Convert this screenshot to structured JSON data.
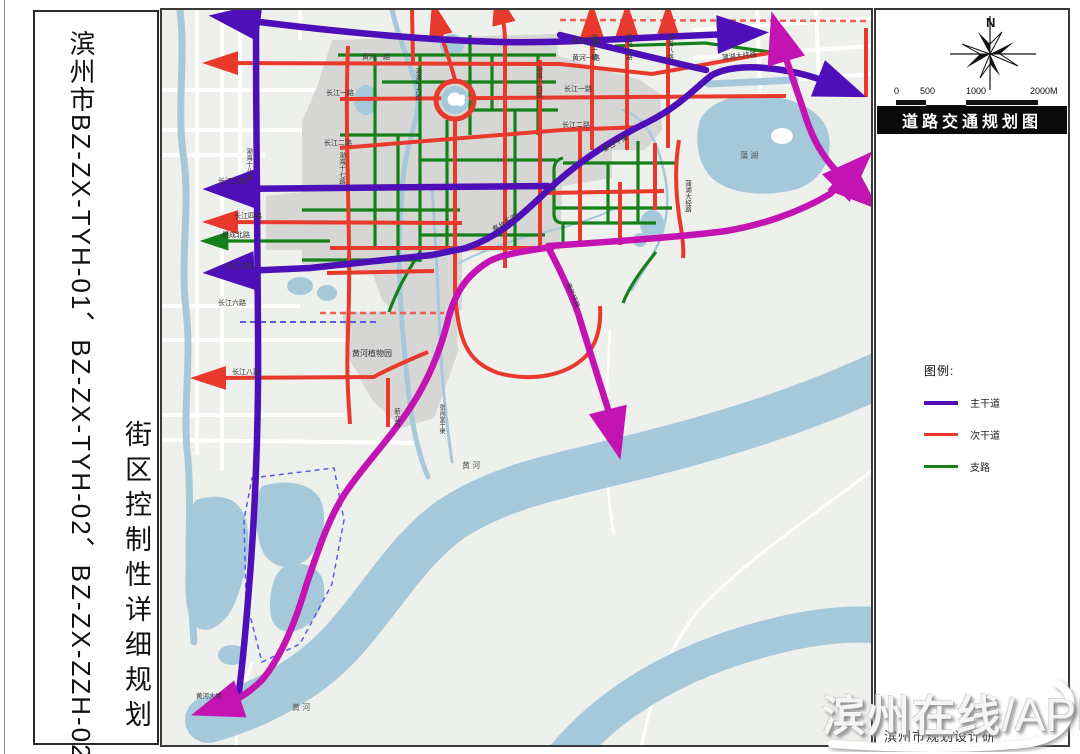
{
  "sheet": {
    "project_title_line1": "滨州市BZ-ZX-TYH-01、BZ-ZX-TYH-02、BZ-ZX-ZZH-02",
    "project_title_line2": "街区控制性详细规划"
  },
  "panel": {
    "compass_label": "N",
    "scale_ticks": [
      "0",
      "500",
      "1000",
      "2000M"
    ],
    "map_title": "道路交通规划图",
    "legend_title": "图例:",
    "legend": [
      {
        "label": "主干道",
        "color": "#4e0fb8"
      },
      {
        "label": "次干道",
        "color": "#e8392c"
      },
      {
        "label": "支路",
        "color": "#15801a"
      }
    ],
    "credit": "滨州市规划设计研"
  },
  "watermark": {
    "text": "滨州在线",
    "slash": "/",
    "suffix": "APP"
  },
  "map": {
    "colors": {
      "main_road": "#4e0fb8",
      "secondary_road": "#e8392c",
      "branch_road": "#15801a",
      "expressway": "#c313b3",
      "water": "#a5c8db",
      "urban": "#d6d7d5",
      "land": "#eef0ec"
    },
    "labels": {
      "hh2": "黄河二路",
      "hh1w": "黄河一路",
      "hh1e": "黄河一路",
      "cj1w": "长江一路",
      "cj1e": "长江一路",
      "cj2w": "长江二路",
      "cj2e": "长江二路",
      "cj3": "长江三路",
      "cj4": "长江四路",
      "kcb": "垦成北路",
      "cj5": "长江五路",
      "cj6": "长江六路",
      "cj8": "长江八路",
      "bh18": "渤海十八路",
      "bh17": "渤海十七路",
      "bh16": "渤海十六路",
      "bh14": "渤海十四路",
      "bh10": "渤海十路",
      "bh9": "渤海九路",
      "bh8": "渤海八路",
      "phw": "蒲湖大纬路",
      "phj": "蒲湖大经路",
      "xlh": "新立河",
      "zxt": "张肖堂干渠",
      "qt1": "秦台干渠",
      "qt2": "秦台干渠",
      "zwy": "黄河植物园",
      "nwh": "南外环路",
      "dab": "黄河大坝",
      "hhr1": "黄  河",
      "hhr2": "黄  河",
      "phl": "蒲  湖"
    }
  }
}
